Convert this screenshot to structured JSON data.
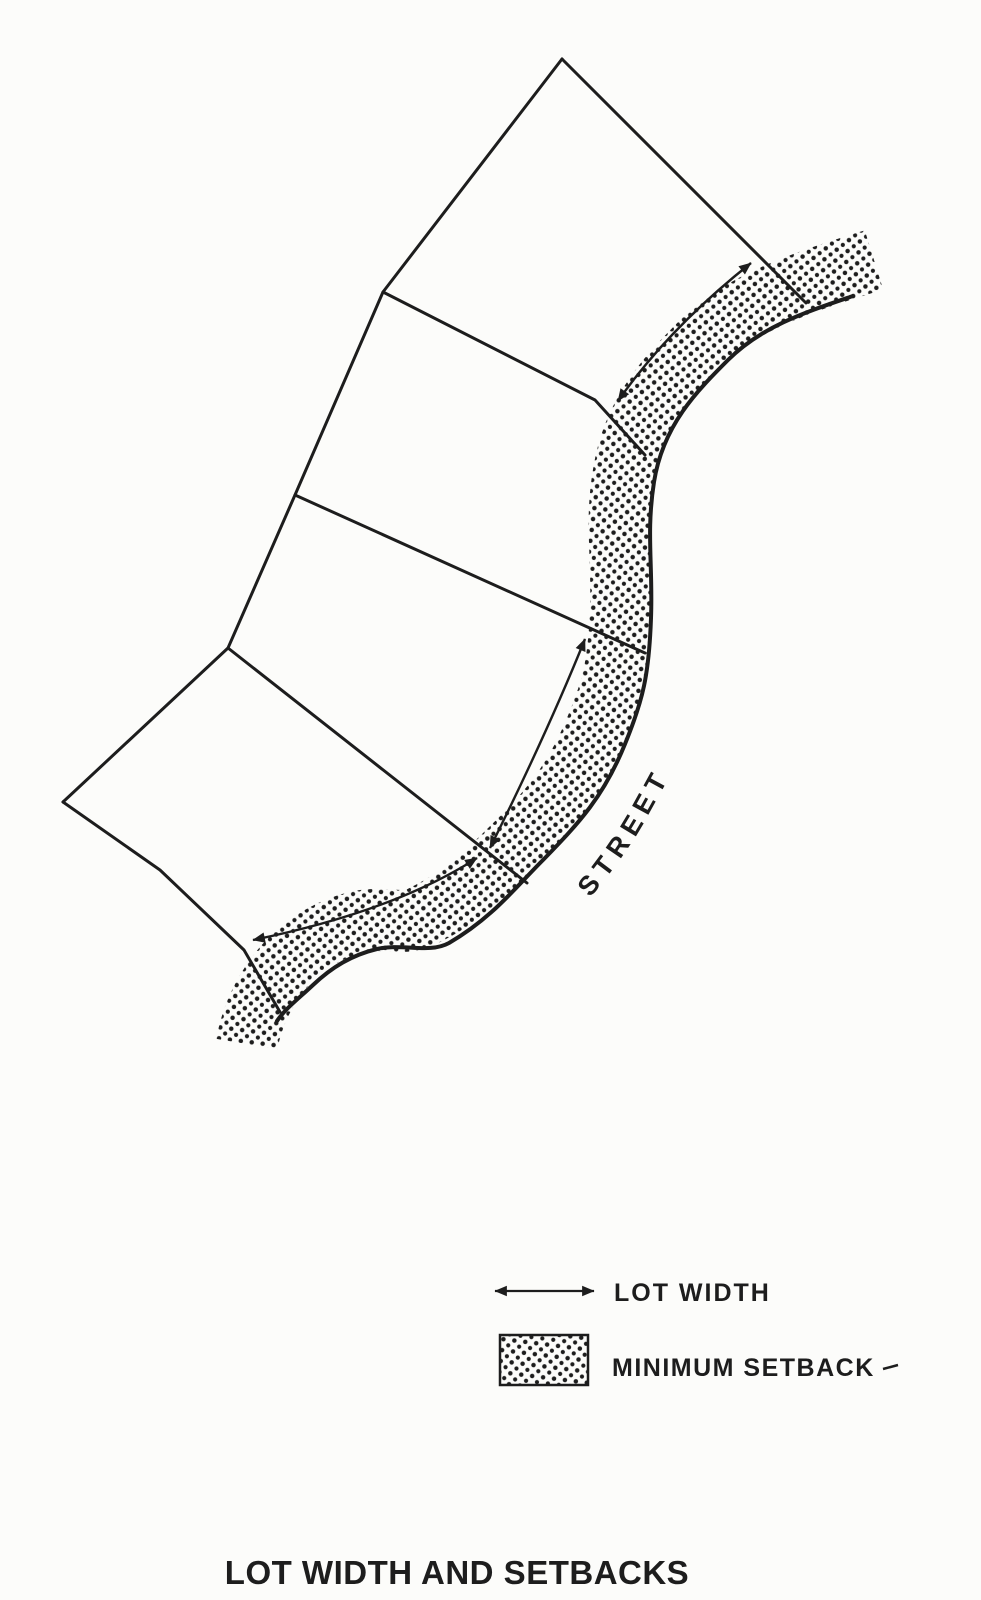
{
  "colors": {
    "ink": "#1d1d1d",
    "paper": "#fcfcfa"
  },
  "figure": {
    "street_label": "STREET",
    "elements": {
      "street_edge": "street-edge-curve",
      "setback_band": "stippled minimum-setback band along street",
      "lot_lines": "four lots divided by side lot lines meeting the curved street",
      "lot_width_arrows": "double-headed arrows along front setback line between side lot lines"
    }
  },
  "legend": {
    "lot_width_label": "LOT WIDTH",
    "minimum_setback_label": "MINIMUM SETBACK"
  },
  "title": "LOT WIDTH AND SETBACKS"
}
